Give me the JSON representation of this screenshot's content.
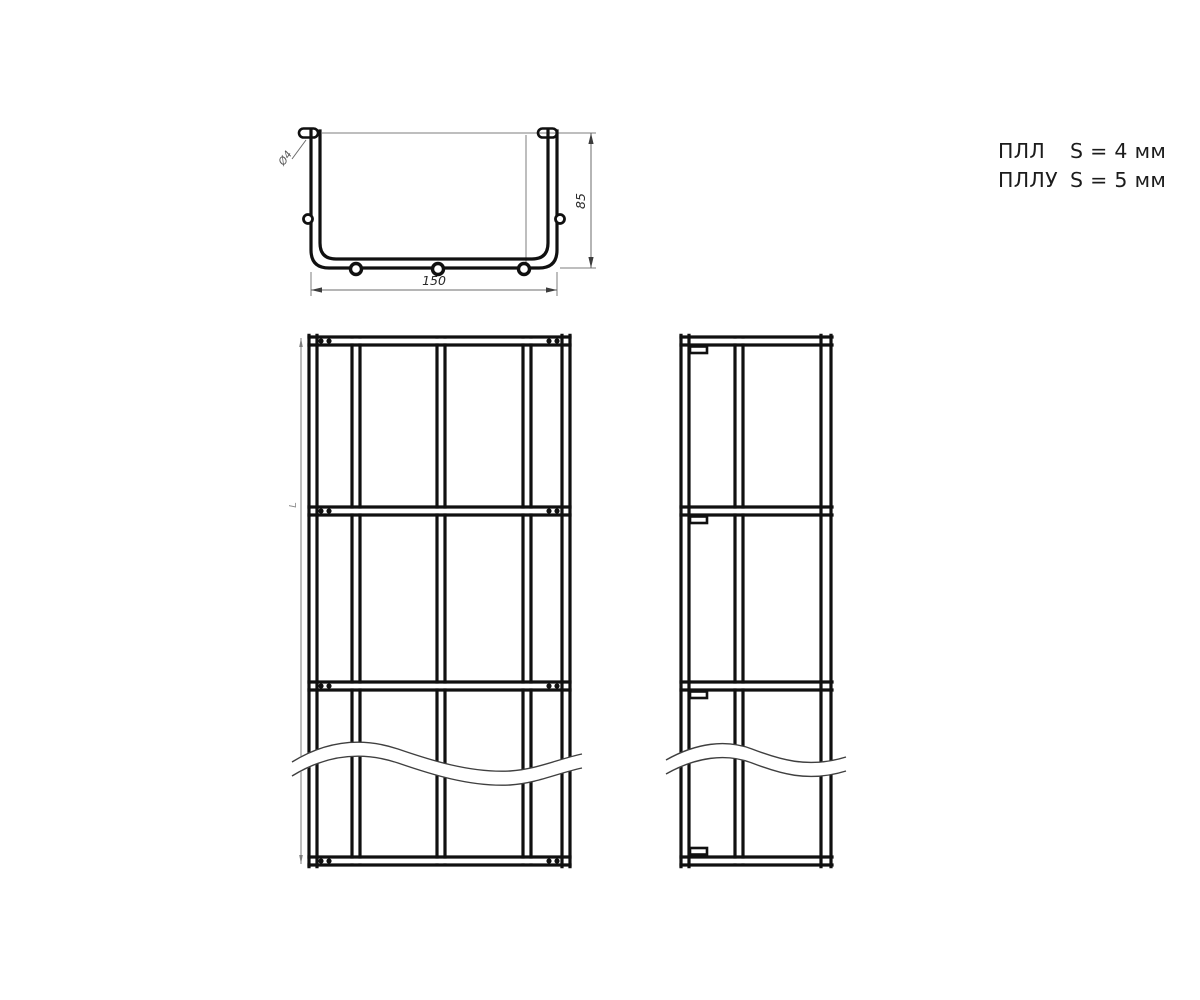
{
  "legend": {
    "items": [
      {
        "name": "ПЛЛ",
        "spec": "S = 4 мм"
      },
      {
        "name": "ПЛЛУ",
        "spec": "S = 5 мм"
      }
    ]
  },
  "section_view": {
    "width_label": "150",
    "height_label": "85",
    "leader_label": "Ø4"
  },
  "front_view": {
    "length_label": "L"
  },
  "colors": {
    "line": "#101010",
    "dim": "#7d7d7d",
    "text": "#1c1c1c",
    "background": "#ffffff"
  }
}
